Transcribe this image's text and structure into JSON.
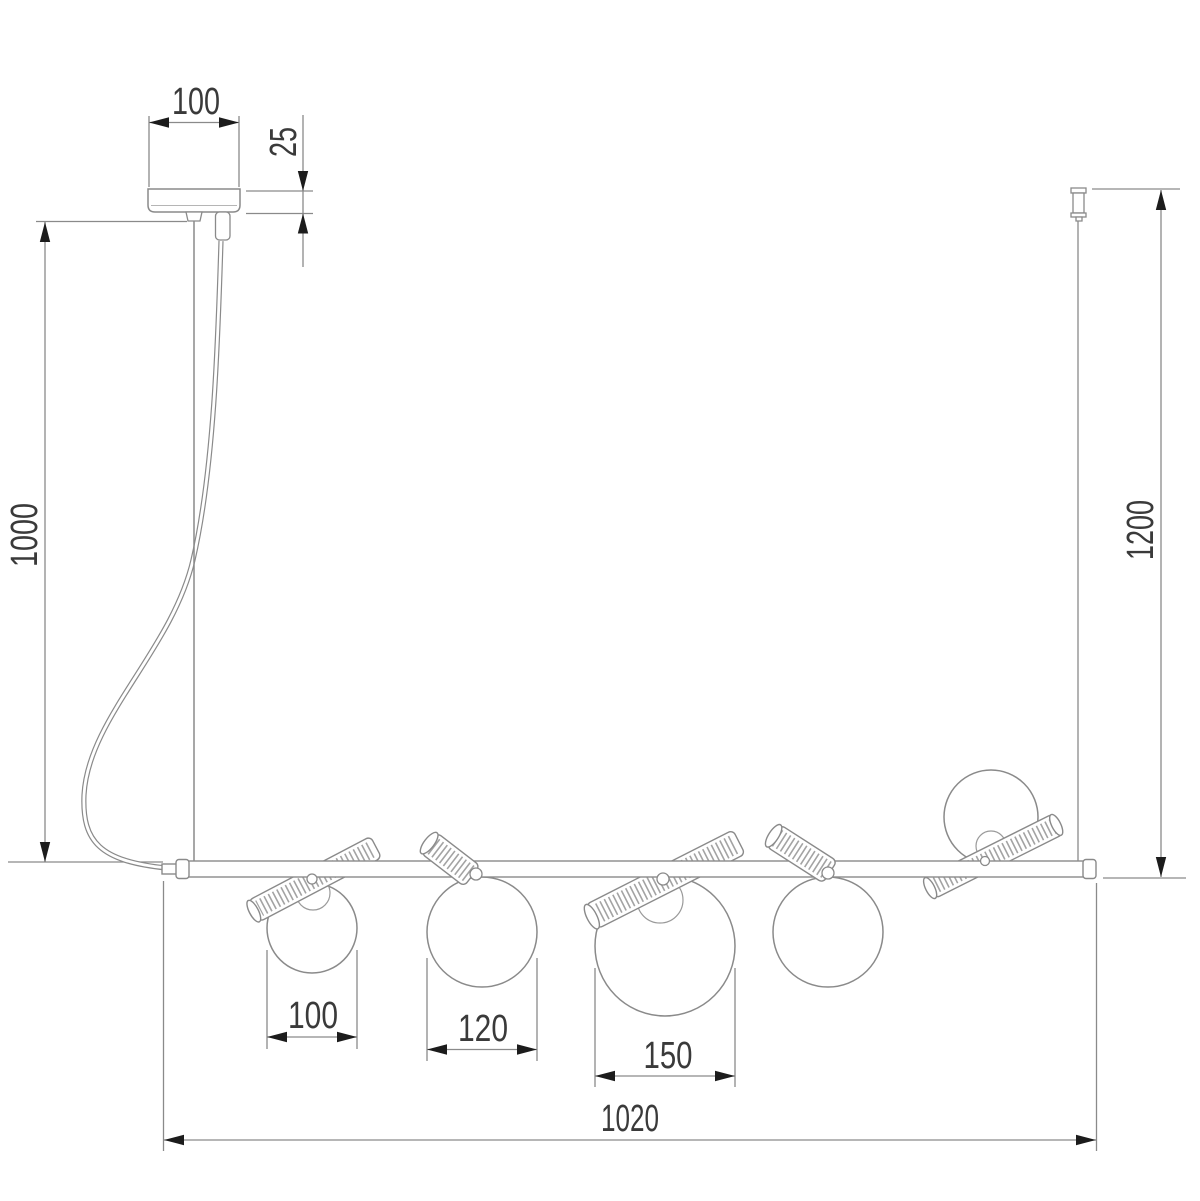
{
  "drawing": {
    "type": "technical-dimension-drawing",
    "subject": "linear pendant chandelier with five globe shades, ceiling canopy and suspension wires",
    "colors": {
      "outline": "#8a8a8a",
      "rib_hatch": "#a3a3a3",
      "dimension_line": "#8a8a8a",
      "arrow": "#1c1c1c",
      "text": "#3a3a3a",
      "background": "#ffffff"
    },
    "dimensions": {
      "canopy_width": "100",
      "canopy_height": "25",
      "left_drop": "1000",
      "right_drop": "1200",
      "globe_small": "100",
      "globe_medium": "120",
      "globe_large": "150",
      "bar_length": "1020"
    }
  }
}
